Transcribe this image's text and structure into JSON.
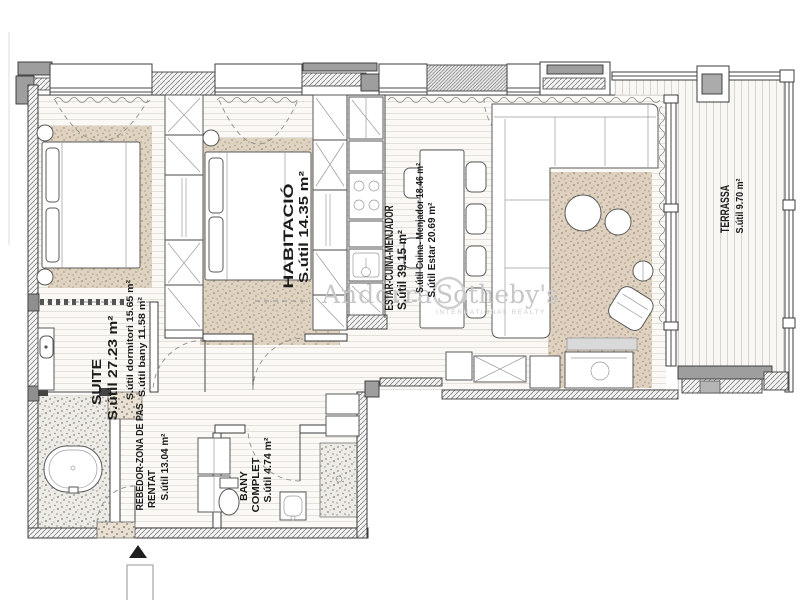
{
  "watermark": {
    "brand_left": "Andorra",
    "brand_right": "Sotheby's",
    "tagline": "INTERNATIONAL REALTY"
  },
  "rooms": {
    "habitacio": {
      "name": "HABITACIÓ",
      "area": "S.útil 14.35 m²"
    },
    "estar": {
      "name": "ESTAR-CUINA-MENJADOR",
      "area": "S.útil 39.15 m²",
      "sub1": "S.útil Cuina- Menjador 18.46 m²",
      "sub2": "S.útil Estar 20.69 m²"
    },
    "terrassa": {
      "name": "TERRASSA",
      "area": "S.útil 9.70 m²"
    },
    "suite": {
      "name": "SUITE",
      "area": "S.útil 27.23 m²",
      "sub1": "S.útil dormitori 15.65 m²",
      "sub2": "S.útil bany 11.58 m²"
    },
    "rebedor": {
      "name": "REBEDOR-ZONA DE PAS",
      "name2": "RENTAT",
      "area": "S.útil 13.04 m²"
    },
    "bany": {
      "name": "BANY",
      "name2": "COMPLET",
      "area": "S.útil 4.74 m²"
    }
  },
  "colors": {
    "wall_gray": "#9e9e9e",
    "rug_tan": "#dccfbc",
    "stone_gray": "#edebe7",
    "line": "#4a4a4a",
    "watermark": "#c7c7c7"
  }
}
